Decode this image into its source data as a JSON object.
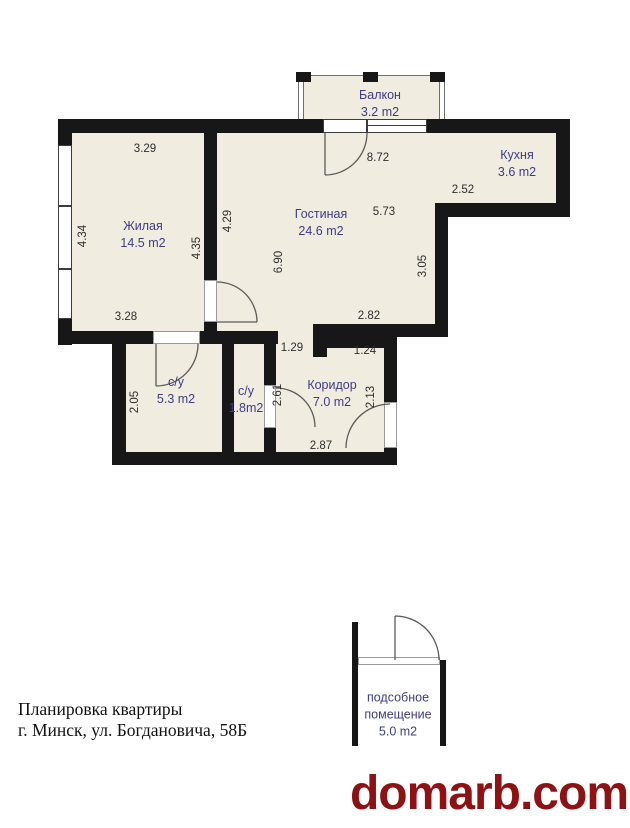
{
  "colors": {
    "fill": "#f0ecdf",
    "wall": "#171717",
    "label": "#3c3c86",
    "dimension": "#2e2e2e",
    "watermark": "#8e1113"
  },
  "rooms": [
    {
      "name": "Балкон",
      "area": "3.2 m2",
      "x": 380,
      "y": 104,
      "wrap": false
    },
    {
      "name": "Кухня",
      "area": "3.6 m2",
      "x": 517,
      "y": 164,
      "wrap": false
    },
    {
      "name": "Жилая",
      "area": "14.5 m2",
      "x": 143,
      "y": 235,
      "wrap": false
    },
    {
      "name": "Гостиная",
      "area": "24.6 m2",
      "x": 321,
      "y": 223,
      "wrap": false
    },
    {
      "name": "с/у",
      "area": "5.3 m2",
      "x": 176,
      "y": 391,
      "wrap": false
    },
    {
      "name": "с/у",
      "area": "1.8m2",
      "x": 246,
      "y": 400,
      "wrap": false
    },
    {
      "name": "Коридор",
      "area": "7.0 m2",
      "x": 332,
      "y": 394,
      "wrap": false
    },
    {
      "name": "подсобное помещение",
      "area": "5.0 m2",
      "x": 398,
      "y": 715,
      "wrap": true
    }
  ],
  "dimensions": [
    {
      "v": "3.29",
      "x": 145,
      "y": 149,
      "rot": false
    },
    {
      "v": "8.72",
      "x": 378,
      "y": 158,
      "rot": false
    },
    {
      "v": "2.52",
      "x": 463,
      "y": 190,
      "rot": false
    },
    {
      "v": "5.73",
      "x": 384,
      "y": 212,
      "rot": false
    },
    {
      "v": "4.34",
      "x": 83,
      "y": 236,
      "rot": true
    },
    {
      "v": "4.29",
      "x": 228,
      "y": 221,
      "rot": true
    },
    {
      "v": "4.35",
      "x": 197,
      "y": 248,
      "rot": true
    },
    {
      "v": "6.90",
      "x": 279,
      "y": 262,
      "rot": true
    },
    {
      "v": "3.05",
      "x": 423,
      "y": 266,
      "rot": true
    },
    {
      "v": "3.28",
      "x": 126,
      "y": 317,
      "rot": false
    },
    {
      "v": "2.82",
      "x": 369,
      "y": 316,
      "rot": false
    },
    {
      "v": "1.29",
      "x": 292,
      "y": 348,
      "rot": false
    },
    {
      "v": "1.24",
      "x": 365,
      "y": 351,
      "rot": false
    },
    {
      "v": "2.05",
      "x": 135,
      "y": 402,
      "rot": true
    },
    {
      "v": "2.61",
      "x": 278,
      "y": 395,
      "rot": true
    },
    {
      "v": "2.13",
      "x": 371,
      "y": 397,
      "rot": true
    },
    {
      "v": "2.87",
      "x": 321,
      "y": 446,
      "rot": false
    }
  ],
  "footer": {
    "line1": "Планировка квартиры",
    "line2": "г. Минск, ул. Богдановича, 58Б"
  },
  "watermark": "domarb.com"
}
